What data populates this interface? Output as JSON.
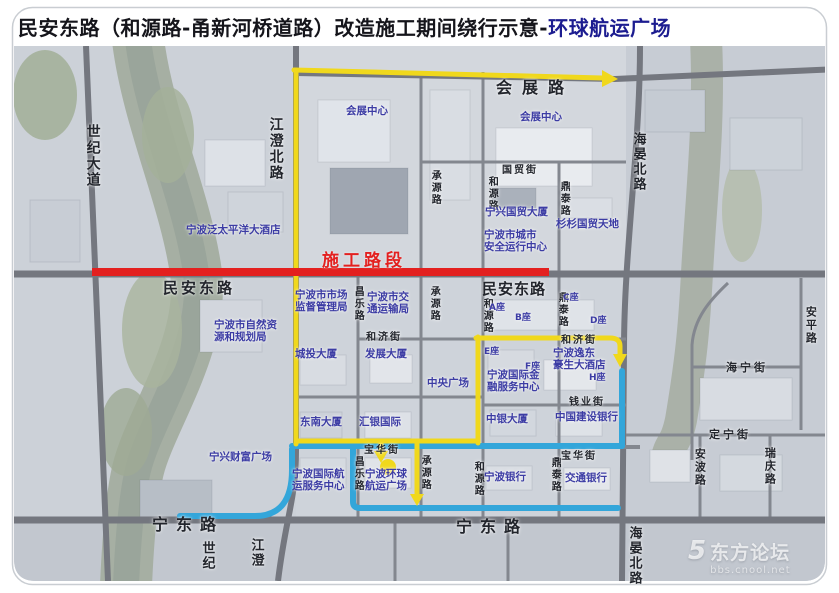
{
  "title": {
    "prefix": "民安东路（和源路-甬新河桥道路）改造施工期间绕行示意-",
    "highlight": "环球航运广场"
  },
  "construction_label": "施工路段",
  "watermark": {
    "site": "东方论坛",
    "url": "bbs.cnool.net"
  },
  "colors": {
    "construction": "#e3201f",
    "detour_yellow": "#f0d81c",
    "detour_blue": "#33a6da",
    "poi_label": "#3c3ca4",
    "road_label": "#22252c",
    "title_highlight": "#1c1c90"
  },
  "road_labels": [
    {
      "t": "世纪大道",
      "x": 84,
      "y": 124,
      "v": true,
      "s": 14
    },
    {
      "t": "江澄北路",
      "x": 267,
      "y": 117,
      "v": true,
      "s": 14
    },
    {
      "t": "会展路",
      "x": 496,
      "y": 79,
      "s": 16,
      "sp": 10
    },
    {
      "t": "国贸街",
      "x": 502,
      "y": 165,
      "s": 10,
      "sp": 2
    },
    {
      "t": "承源路",
      "x": 429,
      "y": 170,
      "v": true,
      "s": 10
    },
    {
      "t": "和源路",
      "x": 486,
      "y": 176,
      "v": true,
      "s": 10
    },
    {
      "t": "鼎泰路",
      "x": 558,
      "y": 181,
      "v": true,
      "s": 10
    },
    {
      "t": "海晏北路",
      "x": 630,
      "y": 132,
      "v": true,
      "s": 13
    },
    {
      "t": "民安东路",
      "x": 163,
      "y": 280,
      "s": 15,
      "sp": 3
    },
    {
      "t": "民安东路",
      "x": 482,
      "y": 281,
      "s": 15,
      "sp": 1
    },
    {
      "t": "昌乐路",
      "x": 352,
      "y": 286,
      "v": true,
      "s": 10
    },
    {
      "t": "承源路",
      "x": 428,
      "y": 286,
      "v": true,
      "s": 10
    },
    {
      "t": "和源路",
      "x": 481,
      "y": 298,
      "v": true,
      "s": 10
    },
    {
      "t": "鼎泰路",
      "x": 556,
      "y": 292,
      "v": true,
      "s": 10
    },
    {
      "t": "和济街",
      "x": 366,
      "y": 332,
      "s": 10,
      "sp": 2
    },
    {
      "t": "和济街",
      "x": 561,
      "y": 335,
      "s": 10,
      "sp": 2
    },
    {
      "t": "钱业街",
      "x": 569,
      "y": 397,
      "s": 10,
      "sp": 2
    },
    {
      "t": "宝华街",
      "x": 364,
      "y": 445,
      "s": 10,
      "sp": 2
    },
    {
      "t": "宝华街",
      "x": 561,
      "y": 451,
      "s": 10,
      "sp": 2
    },
    {
      "t": "昌乐路",
      "x": 352,
      "y": 456,
      "v": true,
      "s": 10
    },
    {
      "t": "承源路",
      "x": 419,
      "y": 455,
      "v": true,
      "s": 10
    },
    {
      "t": "和源路",
      "x": 472,
      "y": 461,
      "v": true,
      "s": 10
    },
    {
      "t": "鼎泰路",
      "x": 549,
      "y": 457,
      "v": true,
      "s": 10
    },
    {
      "t": "海宁街",
      "x": 726,
      "y": 362,
      "s": 11,
      "sp": 3
    },
    {
      "t": "安平路",
      "x": 804,
      "y": 306,
      "v": true,
      "s": 11
    },
    {
      "t": "定宁街",
      "x": 709,
      "y": 429,
      "s": 11,
      "sp": 3
    },
    {
      "t": "安波路",
      "x": 693,
      "y": 448,
      "v": true,
      "s": 11
    },
    {
      "t": "瑞庆路",
      "x": 763,
      "y": 447,
      "v": true,
      "s": 11
    },
    {
      "t": "宁东路",
      "x": 152,
      "y": 516,
      "s": 16,
      "sp": 8
    },
    {
      "t": "宁东路",
      "x": 456,
      "y": 518,
      "s": 16,
      "sp": 8
    },
    {
      "t": "世纪",
      "x": 199,
      "y": 541,
      "v": true,
      "s": 13
    },
    {
      "t": "江澄",
      "x": 248,
      "y": 538,
      "v": true,
      "s": 13
    },
    {
      "t": "海晏北路",
      "x": 626,
      "y": 526,
      "v": true,
      "s": 13
    }
  ],
  "poi_labels": [
    {
      "t": "会展中心",
      "x": 346,
      "y": 106
    },
    {
      "t": "会展中心",
      "x": 520,
      "y": 112
    },
    {
      "t": "宁波泛太平洋大酒店",
      "x": 186,
      "y": 225
    },
    {
      "t": "宁兴国贸大厦",
      "x": 485,
      "y": 207
    },
    {
      "t": "杉杉国贸天地",
      "x": 556,
      "y": 219
    },
    {
      "t": "宁波市城市\n安全运行中心",
      "x": 484,
      "y": 230
    },
    {
      "t": "宁波市市场\n监督管理局",
      "x": 295,
      "y": 290
    },
    {
      "t": "宁波市交\n通运输局",
      "x": 367,
      "y": 292
    },
    {
      "t": "宁波市自然资\n源和规划局",
      "x": 214,
      "y": 320
    },
    {
      "t": "A座",
      "x": 489,
      "y": 303,
      "s": 9
    },
    {
      "t": "B座",
      "x": 515,
      "y": 313,
      "s": 9
    },
    {
      "t": "C座",
      "x": 563,
      "y": 293,
      "s": 9
    },
    {
      "t": "D座",
      "x": 590,
      "y": 316,
      "s": 9
    },
    {
      "t": "城投大厦",
      "x": 295,
      "y": 349
    },
    {
      "t": "发展大厦",
      "x": 365,
      "y": 349
    },
    {
      "t": "E座",
      "x": 484,
      "y": 347,
      "s": 9
    },
    {
      "t": "F座",
      "x": 525,
      "y": 362,
      "s": 9
    },
    {
      "t": "H座",
      "x": 589,
      "y": 373,
      "s": 9
    },
    {
      "t": "宁波逸东\n豪生大酒店",
      "x": 553,
      "y": 348
    },
    {
      "t": "宁波国际金\n融服务中心",
      "x": 487,
      "y": 370
    },
    {
      "t": "中央广场",
      "x": 427,
      "y": 378
    },
    {
      "t": "中银大厦",
      "x": 486,
      "y": 414
    },
    {
      "t": "中国建设银行",
      "x": 555,
      "y": 412
    },
    {
      "t": "东南大厦",
      "x": 300,
      "y": 417
    },
    {
      "t": "汇银国际",
      "x": 359,
      "y": 417
    },
    {
      "t": "宁兴财富广场",
      "x": 209,
      "y": 452
    },
    {
      "t": "宁波国际航\n运服务中心",
      "x": 292,
      "y": 469
    },
    {
      "t": "宁波环球\n航运广场",
      "x": 365,
      "y": 469
    },
    {
      "t": "宁波银行",
      "x": 484,
      "y": 472
    },
    {
      "t": "交通银行",
      "x": 565,
      "y": 473
    }
  ]
}
